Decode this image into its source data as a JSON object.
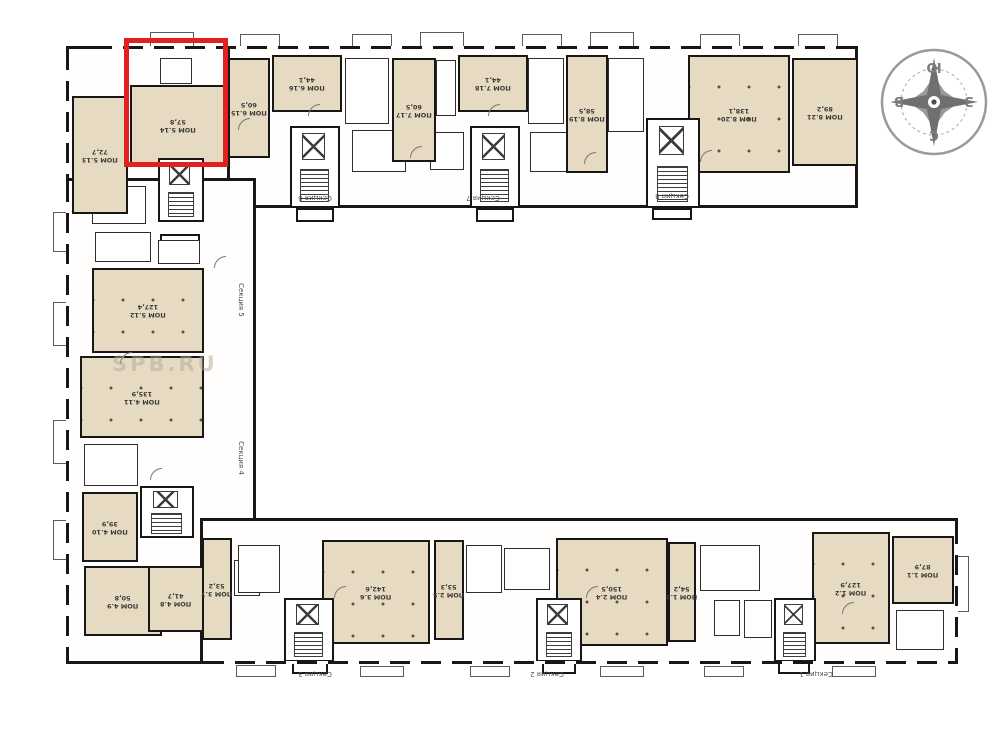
{
  "colors": {
    "highlight_red": "#e3201f",
    "unit_fill": "#e7dac3",
    "wall": "#171717",
    "compass_gray": "#8b8b8b"
  },
  "watermark": {
    "text": "SPB.RU"
  },
  "compass": {
    "top": "Ю",
    "bottom": "С",
    "left": "В",
    "right": "З"
  },
  "highlighted_unit": {
    "name": "ПОМ 5.14",
    "area": "57,8"
  },
  "units": [
    {
      "id": "5.14",
      "name": "ПОМ 5.14",
      "area": "57,8",
      "highlighted": true
    },
    {
      "id": "5.13",
      "name": "ПОМ 5.13",
      "area": "72,7",
      "highlighted": false
    },
    {
      "id": "6.15",
      "name": "ПОМ 6.15",
      "area": "60,5",
      "highlighted": false
    },
    {
      "id": "6.16",
      "name": "ПОМ 6.16",
      "area": "44,1",
      "highlighted": false
    },
    {
      "id": "7.17",
      "name": "ПОМ 7.17",
      "area": "60,5",
      "highlighted": false
    },
    {
      "id": "7.18",
      "name": "ПОМ 7.18",
      "area": "44,1",
      "highlighted": false
    },
    {
      "id": "8.19",
      "name": "ПОМ 8.19",
      "area": "58,5",
      "highlighted": false
    },
    {
      "id": "8.20",
      "name": "ПОМ 8.20",
      "area": "138,1",
      "highlighted": false
    },
    {
      "id": "8.21",
      "name": "ПОМ 8.21",
      "area": "89,2",
      "highlighted": false
    },
    {
      "id": "5.12",
      "name": "ПОМ 5.12",
      "area": "127,4",
      "highlighted": false
    },
    {
      "id": "4.11",
      "name": "ПОМ 4.11",
      "area": "135,9",
      "highlighted": false
    },
    {
      "id": "4.10",
      "name": "ПОМ 4.10",
      "area": "39,9",
      "highlighted": false
    },
    {
      "id": "4.9",
      "name": "ПОМ 4.9",
      "area": "50,8",
      "highlighted": false
    },
    {
      "id": "4.8",
      "name": "ПОМ 4.8",
      "area": "41,7",
      "highlighted": false
    },
    {
      "id": "3.7",
      "name": "ПОМ 3.7",
      "area": "53,2",
      "highlighted": false
    },
    {
      "id": "3.6",
      "name": "ПОМ 3.6",
      "area": "142,6",
      "highlighted": false
    },
    {
      "id": "2.5",
      "name": "ПОМ 2.5",
      "area": "53,3",
      "highlighted": false
    },
    {
      "id": "2.4",
      "name": "ПОМ 2.4",
      "area": "150,5",
      "highlighted": false
    },
    {
      "id": "1.3",
      "name": "ПОМ 1.3",
      "area": "54,2",
      "highlighted": false
    },
    {
      "id": "1.2",
      "name": "ПОМ 1.2",
      "area": "127,9",
      "highlighted": false
    },
    {
      "id": "1.1",
      "name": "ПОМ 1.1",
      "area": "87,9",
      "highlighted": false
    }
  ],
  "sections": [
    {
      "label": "Секция 1"
    },
    {
      "label": "Секция 2"
    },
    {
      "label": "Секция 3"
    },
    {
      "label": "Секция 4"
    },
    {
      "label": "Секция 5"
    },
    {
      "label": "Секция 6"
    },
    {
      "label": "Секция 7"
    },
    {
      "label": "Секция 8"
    }
  ]
}
